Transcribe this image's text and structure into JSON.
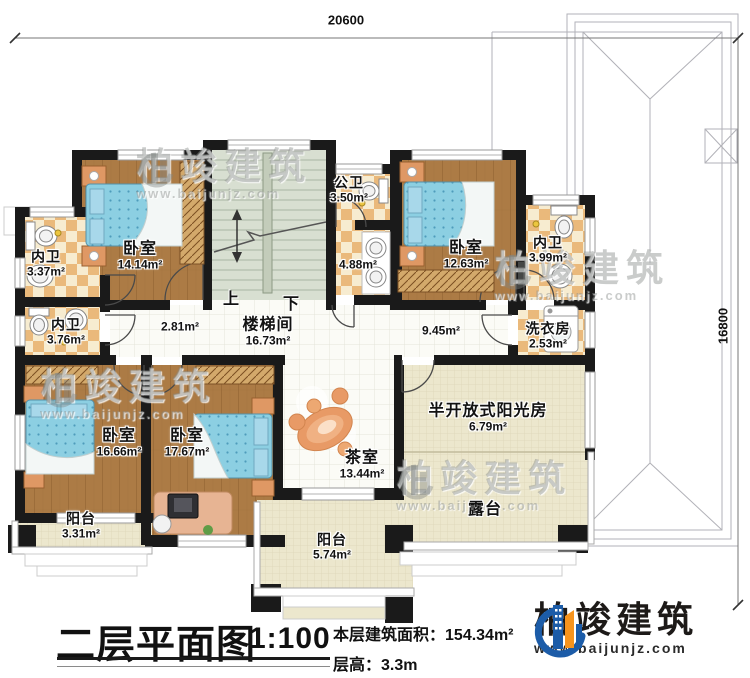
{
  "dimensions": {
    "top": "20600",
    "right": "16800"
  },
  "stairs": {
    "up": "上",
    "down": "下"
  },
  "rooms": [
    {
      "name": "内卫",
      "area": "3.37m²"
    },
    {
      "name": "卧室",
      "area": "14.14m²"
    },
    {
      "name": "公卫",
      "area": "3.50m²"
    },
    {
      "name": "",
      "area": "4.88m²"
    },
    {
      "name": "卧室",
      "area": "12.63m²"
    },
    {
      "name": "内卫",
      "area": "3.99m²"
    },
    {
      "name": "内卫",
      "area": "3.76m²"
    },
    {
      "name": "",
      "area": "2.81m²"
    },
    {
      "name": "楼梯间",
      "area": "16.73m²"
    },
    {
      "name": "",
      "area": "9.45m²"
    },
    {
      "name": "洗衣房",
      "area": "2.53m²"
    },
    {
      "name": "卧室",
      "area": "16.66m²"
    },
    {
      "name": "卧室",
      "area": "17.67m²"
    },
    {
      "name": "茶室",
      "area": "13.44m²"
    },
    {
      "name": "半开放式阳光房",
      "area": "6.79m²"
    },
    {
      "name": "露台",
      "area": ""
    },
    {
      "name": "阳台",
      "area": "3.31m²"
    },
    {
      "name": "阳台",
      "area": "5.74m²"
    }
  ],
  "title_block": {
    "title": "二层平面图",
    "scale": "1:100",
    "area_label": "本层建筑面积：",
    "area_value": "154.34m²",
    "height_label": "层高：",
    "height_value": "3.3m"
  },
  "brand": {
    "name": "柏竣建筑",
    "url": "www.baijunjz.com"
  },
  "watermark": {
    "name": "柏竣建筑",
    "url": "www.baijunjz.com"
  },
  "colors": {
    "wall": "#1a1a1a",
    "wood_floor": "#ac7b45",
    "bath_tile": "#eab97b",
    "stair": "#d8dfd1",
    "terrace": "#ece7cd",
    "bed": "#8ccfe2",
    "brand_blue": "#1c5ca8",
    "brand_orange": "#f7941d"
  }
}
